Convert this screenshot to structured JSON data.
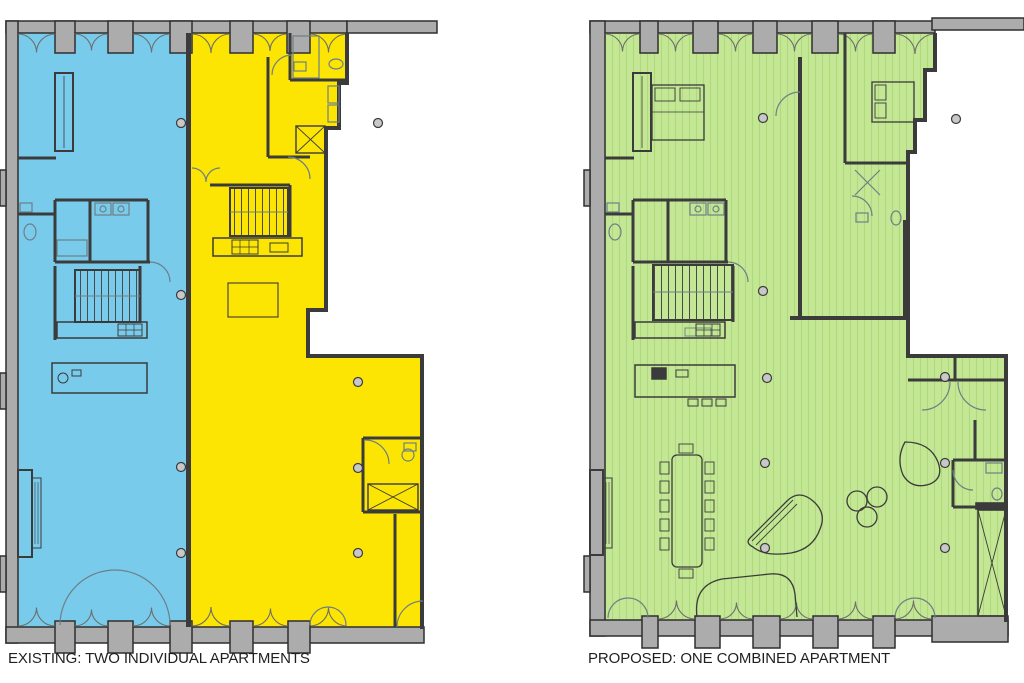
{
  "captions": {
    "existing": "EXISTING: TWO INDIVIDUAL APARTMENTS",
    "proposed": "PROPOSED: ONE COMBINED APARTMENT"
  },
  "colors": {
    "background": "#FFFFFF",
    "apartment_blue": "#79CBEC",
    "apartment_yellow": "#FCE503",
    "apartment_green": "#C3E794",
    "floor_stripe_green": "#AEDA7C",
    "wall_gray": "#ACACAC",
    "wall_outline": "#2F2F2F",
    "line_dark": "#3B3B3B",
    "line_light": "#6F7F86",
    "caption_text": "#231F20"
  }
}
